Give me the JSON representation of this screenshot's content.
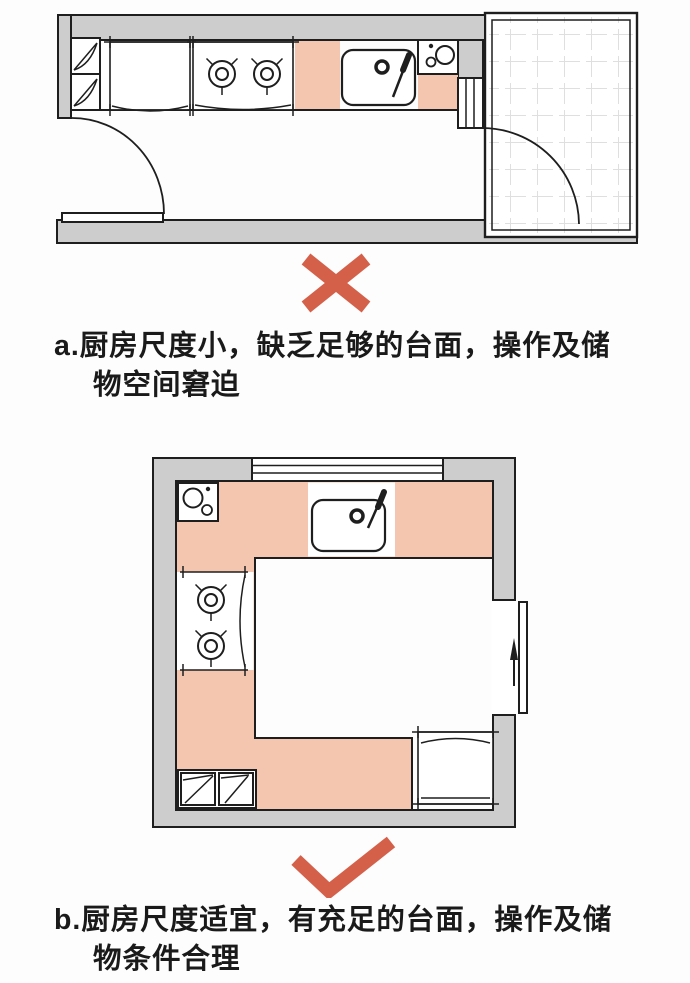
{
  "colors": {
    "accent": "#D4604A",
    "counter": "#F5C6AF",
    "wall": "#CDCDCD",
    "line": "#1E1E1E",
    "tile": "#DFDFDF",
    "text": "#1A1A1A",
    "bg": "#FDFDFD"
  },
  "section_a": {
    "verdict_icon": "x-mark-icon",
    "caption_line1": "a.厨房尺度小，缺乏足够的台面，操作及储",
    "caption_line2": "物空间窘迫"
  },
  "section_b": {
    "verdict_icon": "check-mark-icon",
    "caption_line1": "b.厨房尺度适宜，有充足的台面，操作及储",
    "caption_line2": "物条件合理"
  },
  "icons": {
    "plan_a": [
      "refrigerator-icon",
      "base-cabinet-icon",
      "stove-two-burner-icon",
      "sink-icon",
      "small-appliance-icon",
      "balcony-door-icon",
      "door-swing-arc-icon",
      "tiled-balcony-floor"
    ],
    "plan_b": [
      "small-appliance-icon",
      "sink-icon",
      "stove-two-burner-icon",
      "base-cabinets-icon",
      "refrigerator-icon",
      "window-icon",
      "sliding-door-icon"
    ]
  }
}
